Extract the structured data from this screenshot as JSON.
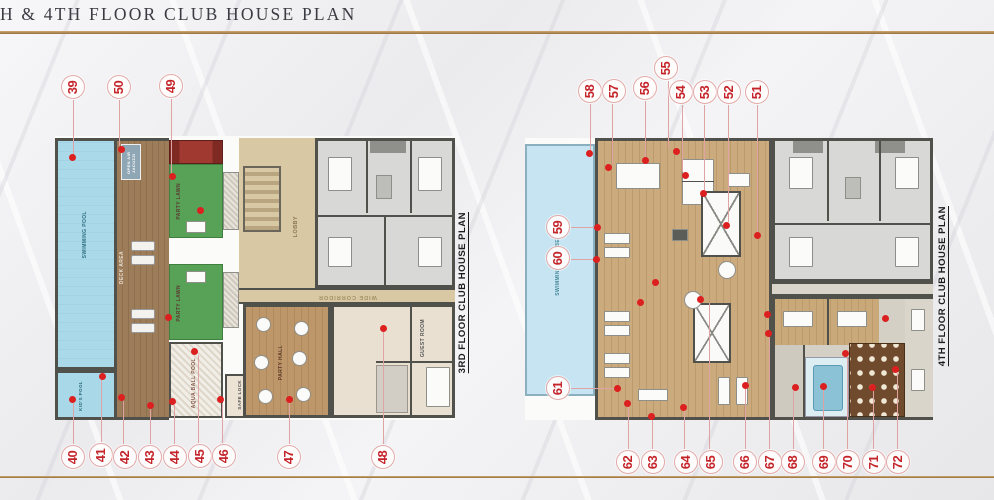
{
  "title": "H & 4TH FLOOR CLUB HOUSE PLAN",
  "colors": {
    "accent_gold": "#b08a56",
    "callout_red": "#c4252b",
    "pool_blue": "#a9d9e9",
    "lawn_green": "#57a257",
    "deck_wood": "#9a7a58",
    "club_wood": "#c8a474",
    "apartment_gray": "#d6d6d4",
    "theater_brown": "#6f4a2c"
  },
  "plans": [
    {
      "label": "3RD FLOOR CLUB HOUSE PLAN",
      "rooms": {
        "swimming_pool": "SWIMMING POOL",
        "kids_pool": "KID'S POOL",
        "deck_area": "DECK AREA",
        "open_air_jacuzzi": "OPEN AIR JACUZZI",
        "party_lawn": "PARTY LAWN",
        "aqua_ball_pool": "AQUA BALL POOL",
        "safe_lock": "SAFE LOCK",
        "lobby": "LOBBY",
        "wide_corridor": "WIDE CORRIDOR",
        "party_hall": "PARTY HALL",
        "guest_room": "GUEST ROOM"
      },
      "callouts_top": [
        "39",
        "50",
        "49"
      ],
      "callouts_bottom": [
        "40",
        "41",
        "42",
        "43",
        "44",
        "45",
        "46",
        "47",
        "48"
      ]
    },
    {
      "label": "4TH FLOOR CLUB HOUSE PLAN",
      "rooms": {
        "swimming_pool_below": "SWIMMING POOL BELOW"
      },
      "callouts_top": [
        "58",
        "57",
        "56",
        "55",
        "54",
        "53",
        "52",
        "51"
      ],
      "callouts_left": [
        "59",
        "60",
        "61"
      ],
      "callouts_bottom": [
        "62",
        "63",
        "64",
        "65",
        "66",
        "67",
        "68",
        "69",
        "70",
        "71",
        "72"
      ]
    }
  ]
}
